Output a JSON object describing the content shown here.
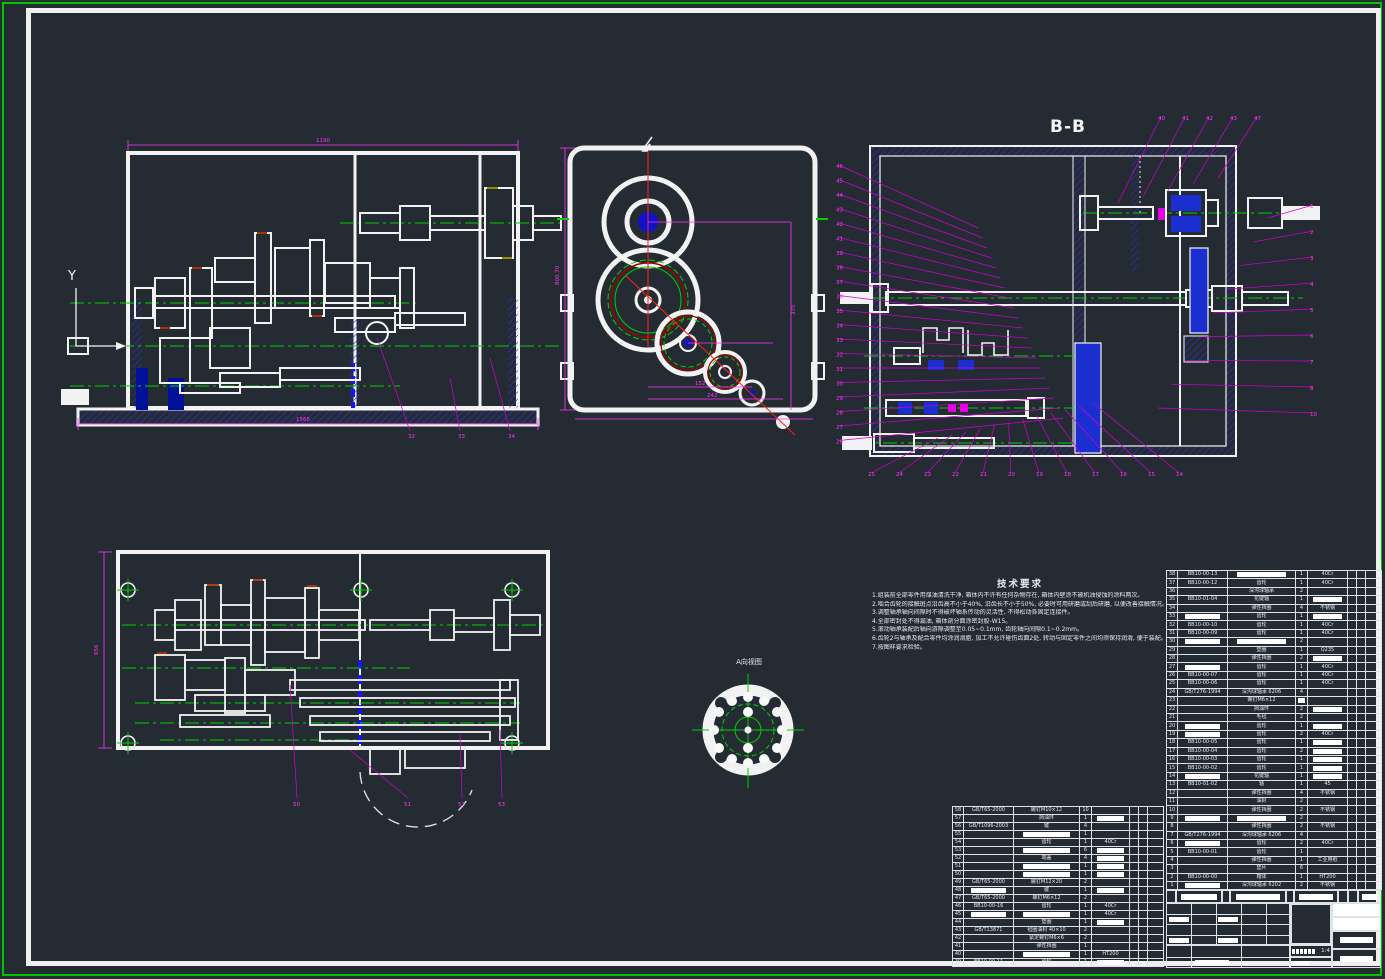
{
  "colors": {
    "background": "#252b33",
    "viewport_border": "#00c400",
    "sheet_border": "#f0f0f0",
    "geometry_white": "#f2f2f2",
    "centerline_green": "#00d200",
    "dimension_magenta": "#ff35ff",
    "hatch_blue": "#2e2ee0",
    "fill_blue": "#1b2fd0",
    "centerline_red": "#ff2020"
  },
  "labels": {
    "section_view": "B-B",
    "view_arrow": "Y",
    "detail_view": "A向视图",
    "tech_title": "技术要求",
    "scale": "1:4"
  },
  "dims": {
    "v1_top": "1190",
    "v1_bottom": "1565",
    "v2_left": "800.70",
    "v2_b1": "152",
    "v2_b2": "242",
    "v2_r1": "375",
    "v4_left": "656"
  },
  "tech_requirements": [
    "1.组装前全部零件用煤油清洗干净, 箱体内不许有任何杂物存在, 箱体内壁涂不被机油侵蚀的涂料两次。",
    "2.啮合齿轮的接触斑点沿齿高不小于40%, 沿齿长不小于50%, 必要时可用研磨或刮后研磨, 以便改善接触情况。",
    "3.调整轴承轴向间隙时不得破坏轴系传动的灵活性, 不得松动各固定连接件。",
    "4.全部密封处不得漏油, 箱体剖分面涂密封胶-W15。",
    "5.滚动轴承装配后轴向游隙调整至0.05~0.1mm, 齿轮轴向间隙0.1~0.2mm。",
    "6.齿轮2与轴承及配合零件均涂润滑脂, 加工不允许碰伤齿面2处, 转动与固定零件之间均须保持润滑, 便于装配。",
    "7.按图样要求检验。"
  ],
  "callouts": {
    "v1_bottom": [
      "32",
      "33",
      "34"
    ],
    "v3_top": [
      "40",
      "41",
      "42",
      "43",
      "47"
    ],
    "v3_left": [
      "46",
      "45",
      "44",
      "43",
      "42",
      "41",
      "39",
      "38",
      "37",
      "36",
      "35",
      "34",
      "33",
      "32",
      "31",
      "30",
      "29",
      "28",
      "27",
      "26"
    ],
    "v3_bottom": [
      "25",
      "24",
      "23",
      "22",
      "21",
      "20",
      "19",
      "18",
      "17",
      "16",
      "15",
      "14"
    ],
    "v3_right": [
      "1",
      "2",
      "3",
      "4",
      "5",
      "6",
      "7",
      "8",
      "10"
    ],
    "v4_bottom": [
      "50",
      "51",
      "52",
      "53"
    ]
  },
  "bom_right": {
    "row_h": 8.42,
    "col_widths": [
      11,
      50,
      68,
      12,
      40,
      9,
      9,
      16
    ],
    "rows": [
      [
        "38",
        "BB10-00-13",
        {
          "m": 1
        },
        "1",
        "40Cr",
        "",
        "",
        ""
      ],
      [
        "37",
        "BB10-00-12",
        "齿轮",
        "1",
        "40Cr",
        "",
        "",
        ""
      ],
      [
        "36",
        "",
        "深沟球轴承",
        "2",
        "",
        "",
        "",
        ""
      ],
      [
        "35",
        "BB10-01-04",
        "花键轴",
        "1",
        {
          "m": 1
        },
        "",
        "",
        ""
      ],
      [
        "34",
        "",
        "弹性挡圈",
        "4",
        "不锈钢",
        "",
        "",
        ""
      ],
      [
        "33",
        {
          "m": 1
        },
        "齿轮",
        "1",
        {
          "m": 1
        },
        "",
        "",
        ""
      ],
      [
        "32",
        "BB10-00-10",
        "齿轮",
        "1",
        "40Cr",
        "",
        "",
        ""
      ],
      [
        "31",
        "BB10-00-09",
        "齿轮",
        "1",
        "40Cr",
        "",
        "",
        ""
      ],
      [
        "30",
        {
          "m": 1
        },
        {
          "m": 1
        },
        "2",
        "",
        "",
        "",
        ""
      ],
      [
        "29",
        "",
        "垫圈",
        "1",
        "Q235",
        "",
        "",
        ""
      ],
      [
        "28",
        "",
        "弹性挡圈",
        "2",
        {
          "m": 1
        },
        "",
        "",
        ""
      ],
      [
        "27",
        {
          "m": 1
        },
        "齿轮",
        "1",
        "40Cr",
        "",
        "",
        ""
      ],
      [
        "26",
        "BB10-00-07",
        "齿轮",
        "1",
        "40Cr",
        "",
        "",
        ""
      ],
      [
        "25",
        "BB10-00-06",
        "齿轮",
        "1",
        "40Cr",
        "",
        "",
        ""
      ],
      [
        "24",
        "GB/T276-1994",
        "深沟球轴承 6206",
        "4",
        "",
        "",
        "",
        ""
      ],
      [
        "23",
        "",
        "螺钉M6×12",
        {
          "m": 1
        },
        "",
        "",
        "",
        ""
      ],
      [
        "22",
        "",
        "挡油环",
        "2",
        {
          "m": 1
        },
        "",
        "",
        ""
      ],
      [
        "21",
        "",
        "毛毡",
        "2",
        "",
        "",
        "",
        ""
      ],
      [
        "20",
        {
          "m": 1
        },
        "齿轮",
        "1",
        {
          "m": 1
        },
        "",
        "",
        ""
      ],
      [
        "19",
        {
          "m": 1
        },
        "齿轮",
        "2",
        "40Cr",
        "",
        "",
        ""
      ],
      [
        "18",
        "BB10-00-05",
        "齿轮",
        "1",
        {
          "m": 1
        },
        "",
        "",
        ""
      ],
      [
        "17",
        "BB10-00-04",
        "齿轮",
        "2",
        {
          "m": 1
        },
        "",
        "",
        ""
      ],
      [
        "16",
        "BB10-00-03",
        "齿轮",
        "1",
        {
          "m": 1
        },
        "",
        "",
        ""
      ],
      [
        "15",
        "BB10-00-02",
        "齿轮",
        "1",
        {
          "m": 1
        },
        "",
        "",
        ""
      ],
      [
        "14",
        {
          "m": 1
        },
        "花键轴",
        "1",
        {
          "m": 1
        },
        "",
        "",
        ""
      ],
      [
        "13",
        "BB10-01-02",
        "轴",
        "1",
        "45",
        "",
        "",
        ""
      ],
      [
        "12",
        "",
        "弹性挡圈",
        "4",
        "不锈钢",
        "",
        "",
        ""
      ],
      [
        "11",
        "",
        "油封",
        "2",
        "",
        "",
        "",
        ""
      ],
      [
        "10",
        "",
        "弹性挡圈",
        "2",
        "不锈钢",
        "",
        "",
        ""
      ],
      [
        "9",
        {
          "m": 1
        },
        {
          "m": 1
        },
        "2",
        "",
        "",
        "",
        ""
      ],
      [
        "8",
        "",
        "弹性挡圈",
        "2",
        "不锈钢",
        "",
        "",
        ""
      ],
      [
        "7",
        "GB/T276-1994",
        "深沟球轴承 6206",
        "4",
        "",
        "",
        "",
        ""
      ],
      [
        "6",
        {
          "m": 1
        },
        "齿轮",
        "2",
        "40Cr",
        "",
        "",
        ""
      ],
      [
        "5",
        "BB10-00-01",
        "齿轮",
        "1",
        "",
        "",
        "",
        ""
      ],
      [
        "4",
        "",
        "弹性挡圈",
        "1",
        "工业用纸",
        "",
        "",
        ""
      ],
      [
        "3",
        "",
        "垫片",
        "6",
        "",
        "",
        "",
        ""
      ],
      [
        "2",
        "BB10-00-00",
        "箱体",
        "1",
        "HT200",
        "",
        "",
        ""
      ],
      [
        "1",
        {
          "m": 1
        },
        "深沟球轴承 6202",
        "2",
        "不锈钢",
        "",
        "",
        ""
      ]
    ]
  },
  "bom_left": {
    "row_h": 8.0,
    "col_widths": [
      11,
      50,
      66,
      12,
      38,
      9,
      9,
      16
    ],
    "rows": [
      [
        "58",
        "GB/T65-2000",
        "螺钉M10×12",
        "10",
        "",
        "",
        "",
        ""
      ],
      [
        "57",
        "",
        "挡油环",
        "1",
        {
          "m": 1
        },
        "",
        "",
        ""
      ],
      [
        "56",
        "GB/T1096-2003",
        "键",
        "4",
        "",
        "",
        "",
        ""
      ],
      [
        "55",
        "",
        {
          "m": 1
        },
        "1",
        "",
        "",
        "",
        ""
      ],
      [
        "54",
        "",
        "齿轮",
        "1",
        "40Cr",
        "",
        "",
        ""
      ],
      [
        "53",
        "",
        {
          "m": 1
        },
        "6",
        {
          "m": 1
        },
        "",
        "",
        ""
      ],
      [
        "52",
        "",
        "端盖",
        "4",
        {
          "m": 1
        },
        "",
        "",
        ""
      ],
      [
        "51",
        "",
        {
          "m": 1
        },
        "1",
        {
          "m": 1
        },
        "",
        "",
        ""
      ],
      [
        "50",
        "",
        {
          "m": 1
        },
        "1",
        {
          "m": 1
        },
        "",
        "",
        ""
      ],
      [
        "49",
        "GB/T65-2000",
        "螺钉M12×20",
        "2",
        "",
        "",
        "",
        ""
      ],
      [
        "48",
        {
          "m": 1
        },
        "键",
        "1",
        {
          "m": 1
        },
        "",
        "",
        ""
      ],
      [
        "47",
        "GB/T65-2000",
        "螺钉M6×12",
        "2",
        "",
        "",
        "",
        ""
      ],
      [
        "46",
        "BB10-00-16",
        "齿轮",
        "1",
        "40Cr",
        "",
        "",
        ""
      ],
      [
        "45",
        {
          "m": 1
        },
        {
          "m": 1
        },
        "1",
        "40Cr",
        "",
        "",
        ""
      ],
      [
        "44",
        "",
        "垫圈",
        "1",
        {
          "m": 1
        },
        "",
        "",
        ""
      ],
      [
        "43",
        "GB/T13871",
        "毡圈油封 40×10",
        "2",
        "",
        "",
        "",
        ""
      ],
      [
        "42",
        "",
        "紧定螺钉M6×6",
        "2",
        "",
        "",
        "",
        ""
      ],
      [
        "41",
        "",
        "弹性挡圈",
        "1",
        "",
        "",
        "",
        ""
      ],
      [
        "40",
        "",
        {
          "m": 1
        },
        "1",
        "HT200",
        "",
        "",
        ""
      ],
      [
        "39",
        "BB10-00-11",
        "齿轮",
        "1",
        {
          "m": 1
        },
        "",
        "",
        ""
      ]
    ]
  }
}
